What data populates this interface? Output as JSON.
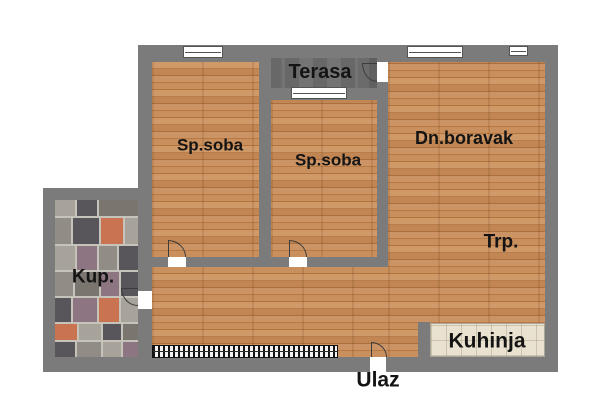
{
  "plan": {
    "type": "apartment-floor-plan",
    "labels": {
      "terrace": "Terasa",
      "bedroom1": "Sp.soba",
      "bedroom2": "Sp.soba",
      "living": "Dn.boravak",
      "dining": "Trp.",
      "bathroom": "Kup.",
      "kitchen": "Kuhinja",
      "entrance": "Ulaz"
    }
  },
  "colors": {
    "wall": "#7b7b7b",
    "wood_floor": "#c08351",
    "terrace_floor": "#6d6d6d",
    "kitchen_floor": "#e9e2d1",
    "bathroom_grout": "#c6c3ba",
    "label_text": "#141414",
    "door_line": "#3c3c3c",
    "window_fill": "#ffffff",
    "bathroom_tile_palette": [
      "#59565b",
      "#7b7570",
      "#c97350",
      "#a8a39a",
      "#918c85",
      "#8d7581"
    ]
  }
}
